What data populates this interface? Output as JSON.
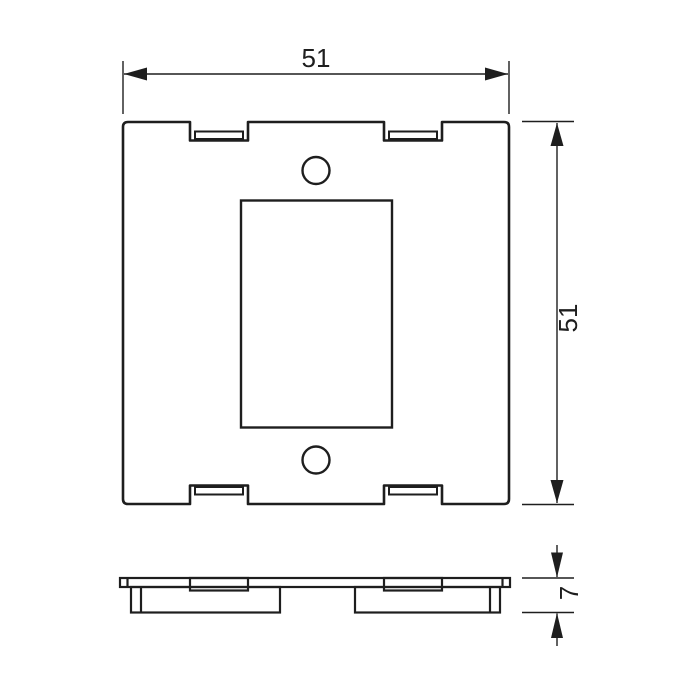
{
  "drawing": {
    "dimensions": {
      "width": "51",
      "height": "51",
      "thickness": "7"
    },
    "style": {
      "line_color": "#1e1e1e",
      "background_color": "#ffffff"
    }
  }
}
